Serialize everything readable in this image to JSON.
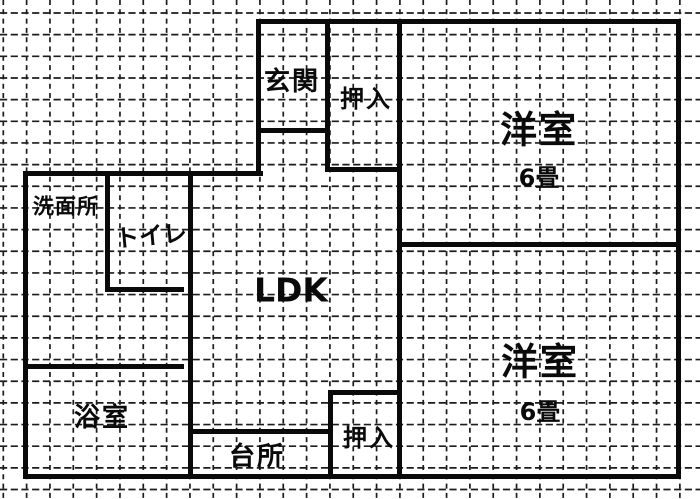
{
  "title": "floor-plan",
  "rooms": {
    "genkan": {
      "label": "玄関"
    },
    "oshiire_upper": {
      "label": "押入"
    },
    "western_upper": {
      "label": "洋室",
      "size": "6畳"
    },
    "washroom": {
      "label": "洗面所"
    },
    "toilet": {
      "label": "トイレ"
    },
    "ldk": {
      "label": "LDK"
    },
    "bathroom": {
      "label": "浴室"
    },
    "kitchen": {
      "label": "台所"
    },
    "oshiire_lower": {
      "label": "押入"
    },
    "western_lower": {
      "label": "洋室",
      "size": "6畳"
    }
  },
  "colors": {
    "wall": "#0a0a0a",
    "grid": "#1c1c1c",
    "background": "#ffffff",
    "text": "#0a0a0a"
  }
}
